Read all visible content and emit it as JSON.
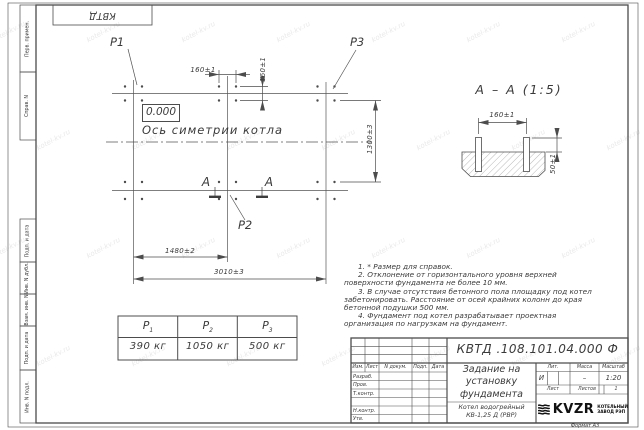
{
  "watermark": "kotel-kv.ru",
  "frame": {
    "top_designation": "КВТД .108.101.04.000 Ф",
    "left_stamps": {
      "perv_primen": "Перв. примен.",
      "sprav_n": "Справ. N",
      "podp_data_1": "Подп. и дата",
      "inv_n_dubl": "Инв. N дубл.",
      "vzam_inv_n": "Взам. инв. N",
      "podp_data_2": "Подп. и дата",
      "inv_n_podl": "Инв. N подл."
    },
    "format_note": "Формат А3"
  },
  "plan": {
    "p1_label": "Р1",
    "p2_label": "Р2",
    "p3_label": "Р3",
    "elevation": "0.000",
    "axis_label": "Ось симетрии котла",
    "section_letter_left": "А",
    "section_letter_right": "А",
    "dims": {
      "top_horizontal": "160±1",
      "top_vertical": "160±1",
      "right_vertical": "1300±3",
      "bottom_inner": "1480±2",
      "bottom_outer": "3010±3"
    }
  },
  "section_view": {
    "title": "А – А (1:5)",
    "dim_width": "160±1",
    "dim_height": "50±1"
  },
  "notes": [
    "1. * Размер для справок.",
    "2. Отклонение от горизонтального уровня верхней поверхности фундамента не более 10 мм.",
    "3. В случае отсутствия бетонного пола площадку под котел забетонировать. Расстояние от осей крайних колонн до края бетонной подушки 500 мм.",
    "4. Фундамент под котел разрабатывает проектная организация по нагрузкам на фундамент."
  ],
  "load_table": {
    "headers": [
      {
        "base": "Р",
        "sub": "1"
      },
      {
        "base": "Р",
        "sub": "2"
      },
      {
        "base": "Р",
        "sub": "3"
      }
    ],
    "values": [
      "390 кг",
      "1050 кг",
      "500 кг"
    ]
  },
  "title_block": {
    "designation": "КВТД .108.101.04.000 Ф",
    "rev_header": {
      "izm": "Изм.",
      "list": "Лист",
      "n_dokum": "N докум.",
      "podp": "Подп.",
      "data": "Дата"
    },
    "staff_rows": {
      "razrab": "Разраб.",
      "prov": "Пров.",
      "t_kontr": "Т.контр.",
      "n_kontr": "Н.контр.",
      "utv": "Утв."
    },
    "title_lines": [
      "Задание на",
      "установку",
      "фундамента"
    ],
    "subtitle_lines": [
      "Котел водогрейный",
      "КВ-1,25 Д (РВР)"
    ],
    "lit_label": "Лит.",
    "lit_value": "И",
    "mass_label": "Масса",
    "mass_value": "–",
    "scale_label": "Масштаб",
    "scale_value": "1:20",
    "sheet_label": "Лист",
    "sheets_label": "Листов",
    "sheets_value": "1",
    "logo_text": "KVZR",
    "logo_caption": [
      "КОТЕЛЬНЫЙ",
      "ЗАВОД РЭП"
    ]
  }
}
